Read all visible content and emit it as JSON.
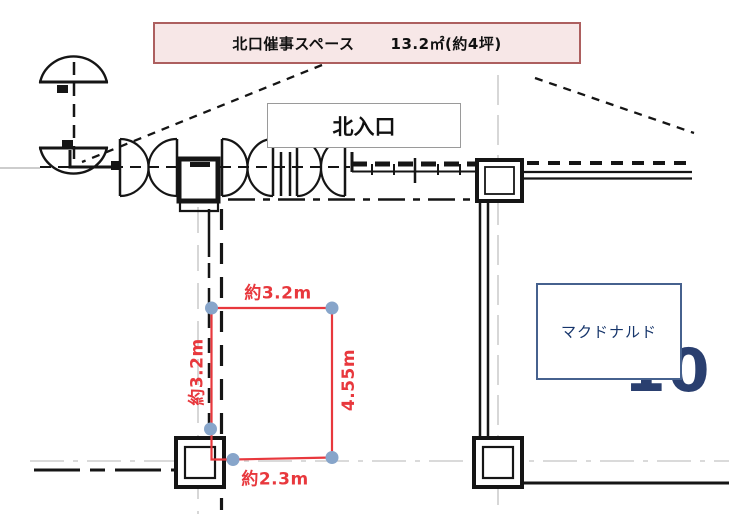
{
  "banner": {
    "title": "北口催事スペース",
    "area": "13.2㎡(約4坪)"
  },
  "plan_labels": {
    "north_entrance": "北入口",
    "tenant": "マクドナルド",
    "background_number": "10"
  },
  "measurements": {
    "top": "約3.2m",
    "left": "約3.2m",
    "right": "4.55m",
    "bottom": "約2.3m"
  },
  "colors": {
    "banner_fill": "#f7e7e7",
    "banner_border": "#ad5f5f",
    "measure_red": "#e8383d",
    "marker_blue": "#87a5ca",
    "tenant_navy": "#16356b",
    "tenant_border": "#46618e",
    "grid_gray": "#cdcdcd",
    "line_black": "#151515"
  }
}
